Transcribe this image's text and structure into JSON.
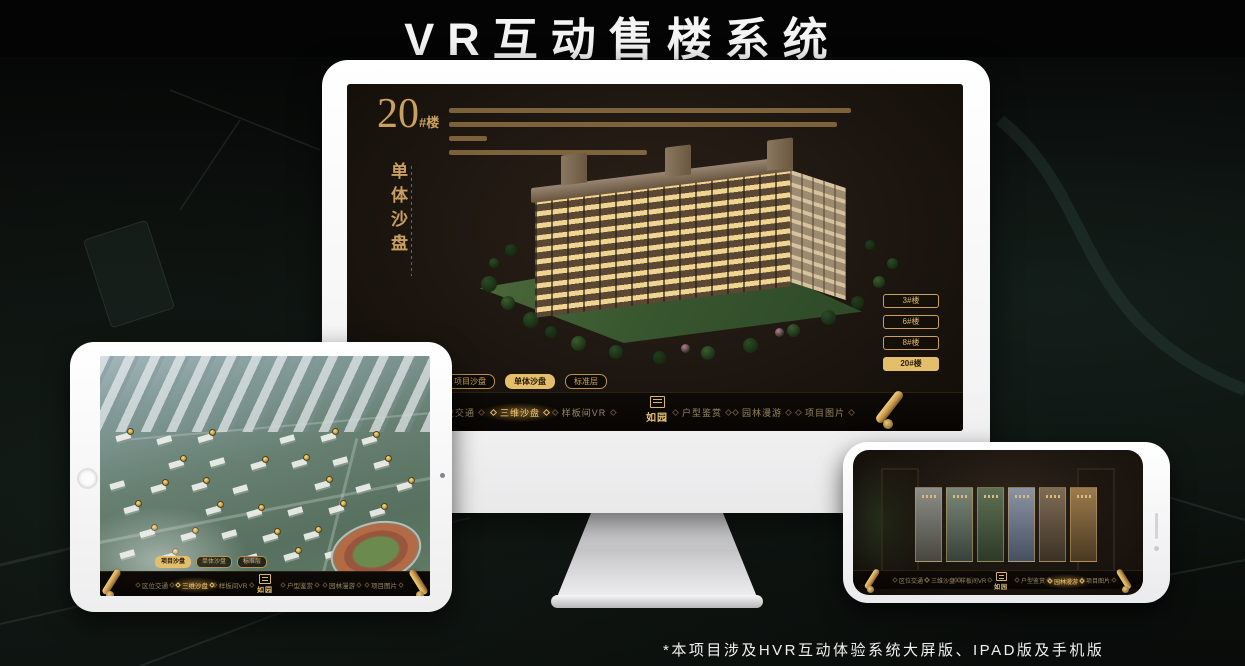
{
  "page": {
    "title": "VR互动售楼系统",
    "footnote": "*本项目涉及HVR互动体验系统大屏版、IPAD版及手机版"
  },
  "colors": {
    "gold": "#c9a05e",
    "gold_bright": "#e5be6c",
    "screen_bg": "#1d1610",
    "navbar_bg": "#0d0a07",
    "device_white": "#f5f5f5"
  },
  "desktop": {
    "headline": {
      "number": "20",
      "suffix": "#楼",
      "section": "单体沙盘"
    },
    "floor_buttons": [
      {
        "label": "3#楼",
        "active": false
      },
      {
        "label": "6#楼",
        "active": false
      },
      {
        "label": "8#楼",
        "active": false
      },
      {
        "label": "20#楼",
        "active": true
      }
    ],
    "sub_tabs": [
      {
        "label": "项目沙盘",
        "active": false
      },
      {
        "label": "单体沙盘",
        "active": true
      },
      {
        "label": "标准层",
        "active": false
      }
    ],
    "nav_items": [
      {
        "label": "区位交通",
        "active": false
      },
      {
        "label": "三维沙盘",
        "active": true
      },
      {
        "label": "样板间VR",
        "active": false
      },
      {
        "label": "户型鉴赏",
        "active": false
      },
      {
        "label": "园林漫游",
        "active": false
      },
      {
        "label": "项目图片",
        "active": false
      }
    ],
    "logo": "如园"
  },
  "tablet": {
    "sub_tabs": [
      {
        "label": "项目沙盘",
        "active": true
      },
      {
        "label": "单体沙盘",
        "active": false
      },
      {
        "label": "标准层",
        "active": false
      }
    ],
    "nav_items": [
      {
        "label": "区位交通",
        "active": false
      },
      {
        "label": "三维沙盘",
        "active": true
      },
      {
        "label": "样板间VR",
        "active": false
      },
      {
        "label": "户型鉴赏",
        "active": false
      },
      {
        "label": "园林漫游",
        "active": false
      },
      {
        "label": "项目图片",
        "active": false
      }
    ],
    "logo": "如园"
  },
  "phone": {
    "nav_items": [
      {
        "label": "区位交通",
        "active": false
      },
      {
        "label": "三维沙盘",
        "active": false
      },
      {
        "label": "样板间VR",
        "active": false
      },
      {
        "label": "户型鉴赏",
        "active": false
      },
      {
        "label": "园林漫游",
        "active": true
      },
      {
        "label": "项目图片",
        "active": false
      }
    ],
    "logo": "如园"
  }
}
